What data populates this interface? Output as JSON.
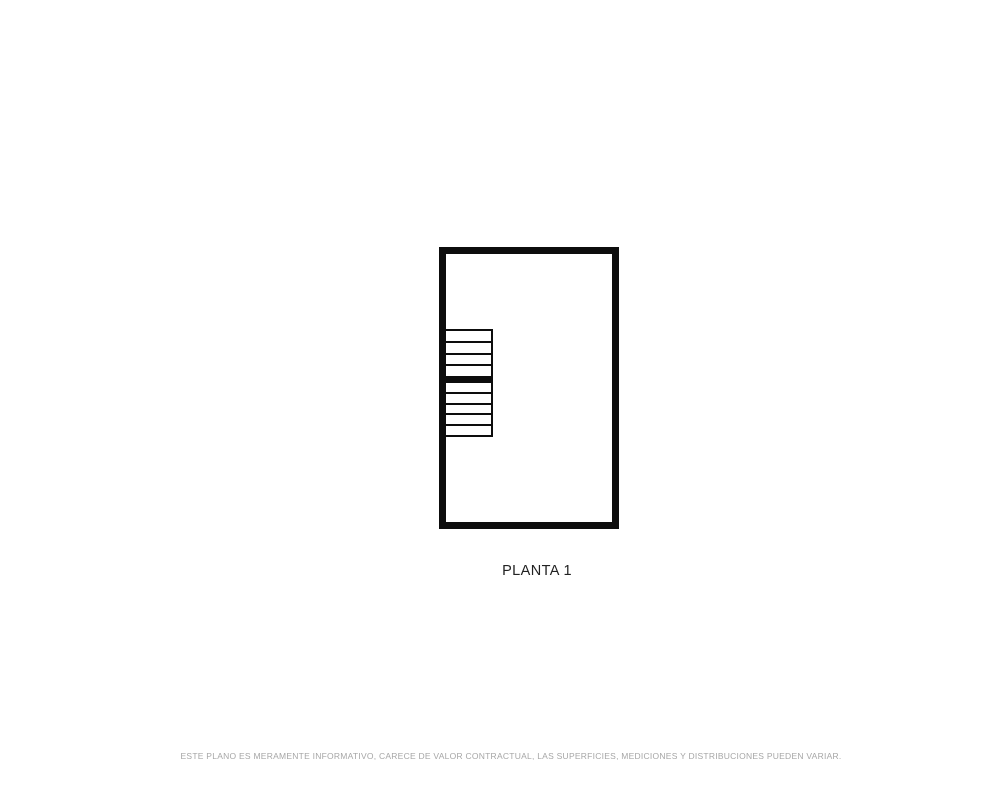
{
  "floorplan": {
    "label": "PLANTA 1",
    "disclaimer": "ESTE PLANO ES MERAMENTE INFORMATIVO, CARECE DE VALOR CONTRACTUAL, LAS SUPERFICIES, MEDICIONES Y DISTRIBUCIONES PUEDEN VARIAR.",
    "stairs": {
      "upper_flight_steps": 4,
      "lower_flight_steps": 5
    },
    "colors": {
      "page_background": "#ffffff",
      "wall": "#0d0d0d",
      "label_text": "#222222",
      "disclaimer_text": "#a6a6a6"
    }
  }
}
